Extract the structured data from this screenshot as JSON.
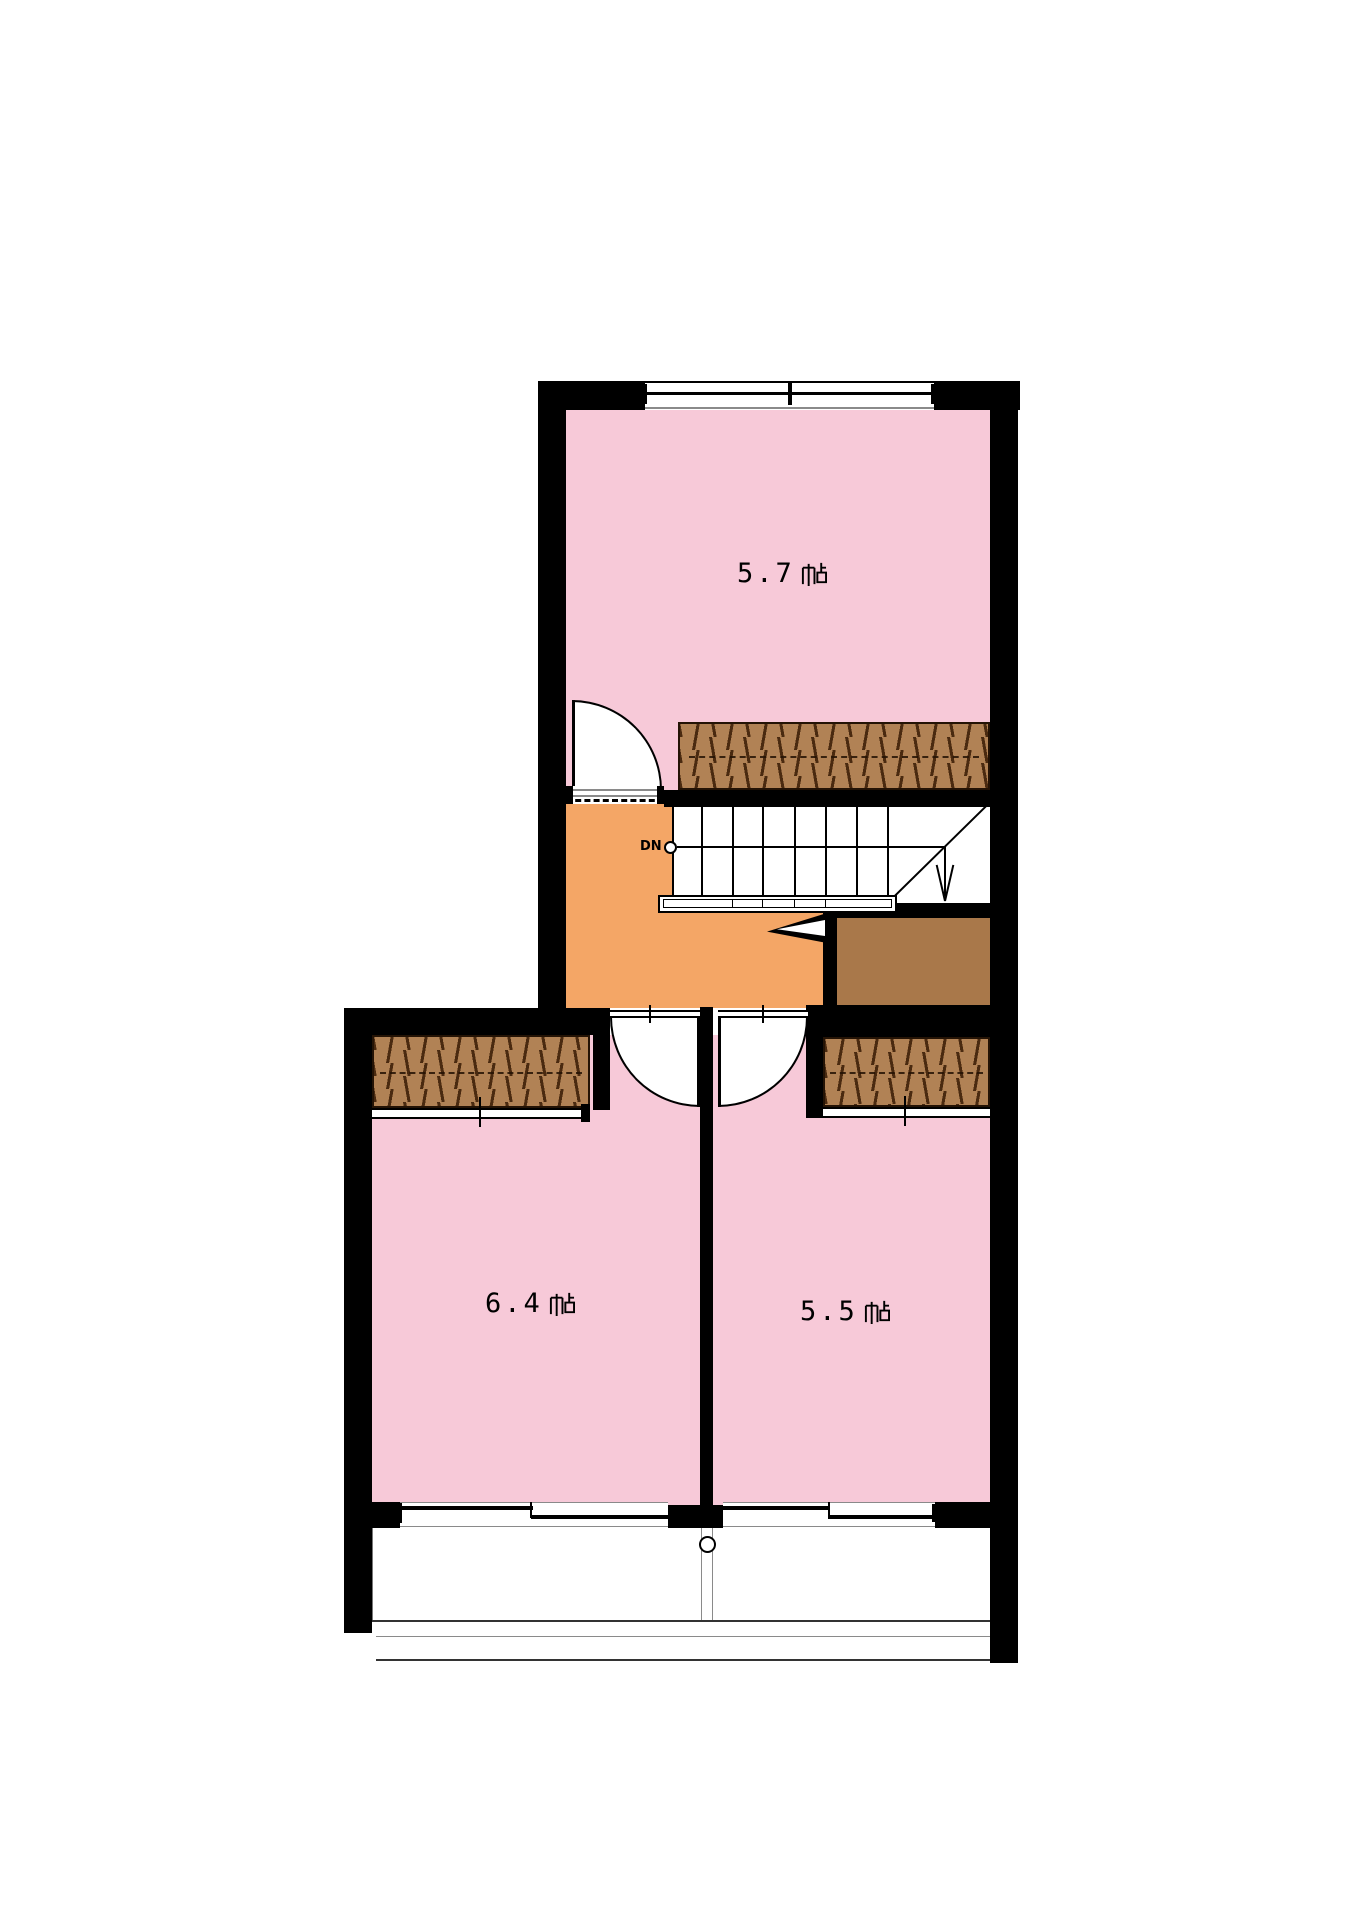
{
  "floor_plan": {
    "type": "residential-upper-floor-plan",
    "rooms": [
      {
        "id": "room-upper",
        "label": "5.7帖",
        "size_value": "5.7",
        "size_unit": "帖"
      },
      {
        "id": "room-lower-left",
        "label": "6.4帖",
        "size_value": "6.4",
        "size_unit": "帖"
      },
      {
        "id": "room-lower-right",
        "label": "5.5帖",
        "size_value": "5.5",
        "size_unit": "帖"
      }
    ],
    "stairs": {
      "direction_label": "DN",
      "direction_arrow": "down",
      "tread_count": 8
    },
    "symbols": {
      "closet_hatch": "wood-grain-hatch",
      "door_swing": "quarter-circle-arc",
      "sliding_window": "double-offset-line",
      "balcony_fixture": "circle"
    },
    "colors": {
      "room_fill": "#F7C9D8",
      "hall_fill": "#F4A666",
      "closet_hatch_fill": "#B18255",
      "closet_plain_fill": "#A9784A",
      "wall": "#000000",
      "background": "#FFFFFF"
    }
  }
}
